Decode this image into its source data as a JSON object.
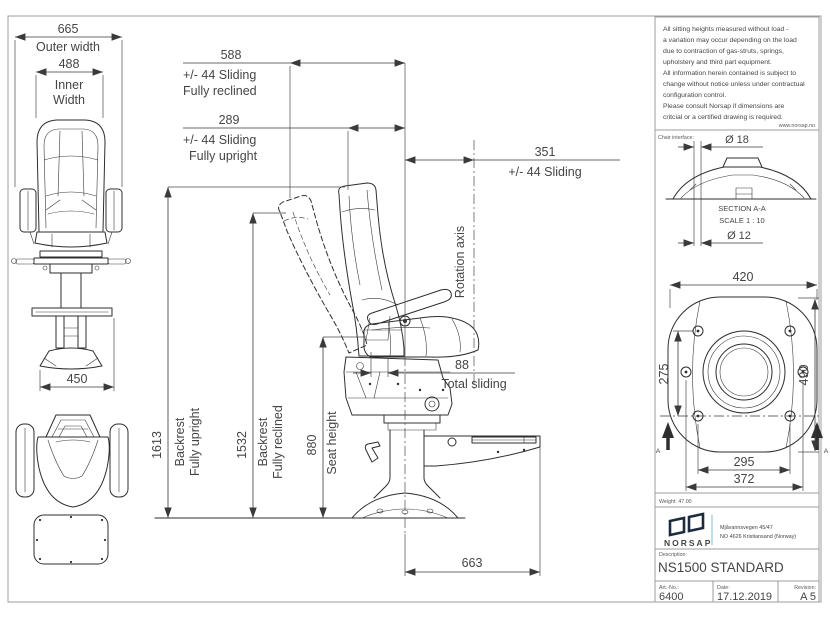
{
  "notes": {
    "lines": [
      "All sitting heights measured without load -",
      "a variation may occur depending on the load",
      "due to contraction of gas-struts, springs,",
      "upholstery and third part equipment.",
      "All information herein contained is subject to",
      "change without notice unless under contractual",
      "configuration control.",
      "Please consult Norsap if dimensions are",
      "critcial or a certified drawing is required."
    ],
    "website": "www.norsap.no"
  },
  "interface_section": {
    "label": "Chair interface:",
    "dia_outer": "Ø 18",
    "dia_inner": "Ø 12",
    "title": "SECTION A-A",
    "scale": "SCALE 1 : 10",
    "marker": "A"
  },
  "front_view": {
    "outer_width": {
      "value": "665",
      "label": "Outer width"
    },
    "inner_width": {
      "value": "488",
      "label1": "Inner",
      "label2": "Width"
    },
    "base_width": {
      "value": "450"
    }
  },
  "side_view": {
    "rotation_axis_label": "Rotation axis",
    "d588": {
      "value": "588",
      "line1": "+/- 44 Sliding",
      "line2": "Fully reclined"
    },
    "d289": {
      "value": "289",
      "line1": "+/- 44 Sliding",
      "line2": "Fully upright"
    },
    "d351": {
      "value": "351",
      "label": "+/- 44 Sliding"
    },
    "d88": {
      "value": "88",
      "label": "Total sliding"
    },
    "d1613": {
      "value": "1613",
      "line1": "Backrest",
      "line2": "Fully upright"
    },
    "d1532": {
      "value": "1532",
      "line1": "Backrest",
      "line2": "Fully reclined"
    },
    "d880": {
      "value": "880",
      "label": "Seat height"
    },
    "d663": {
      "value": "663"
    }
  },
  "base_view": {
    "width": "420",
    "bolt_height": "275",
    "depth": "490",
    "bolt_span": "295",
    "outer_bolt_span": "372",
    "marker": "A"
  },
  "title_block": {
    "weight": "Weight: 47.00",
    "brand": "NORSAP",
    "address1": "Mjåvannsvegen 45/47",
    "address2": "NO 4626  Kristiansand (Norway)",
    "description_label": "Description:",
    "description": "NS1500 STANDARD",
    "art_label": "Art.-No.:",
    "art_no": "6400",
    "date_label": "Date:",
    "date": "17.12.2019",
    "revision_label": "Revision:",
    "revision": "A 5"
  },
  "colors": {
    "line": "#2e2e2e",
    "brand": "#1c2b3d",
    "address": "#8496a6",
    "divider": "#a9cce6"
  }
}
